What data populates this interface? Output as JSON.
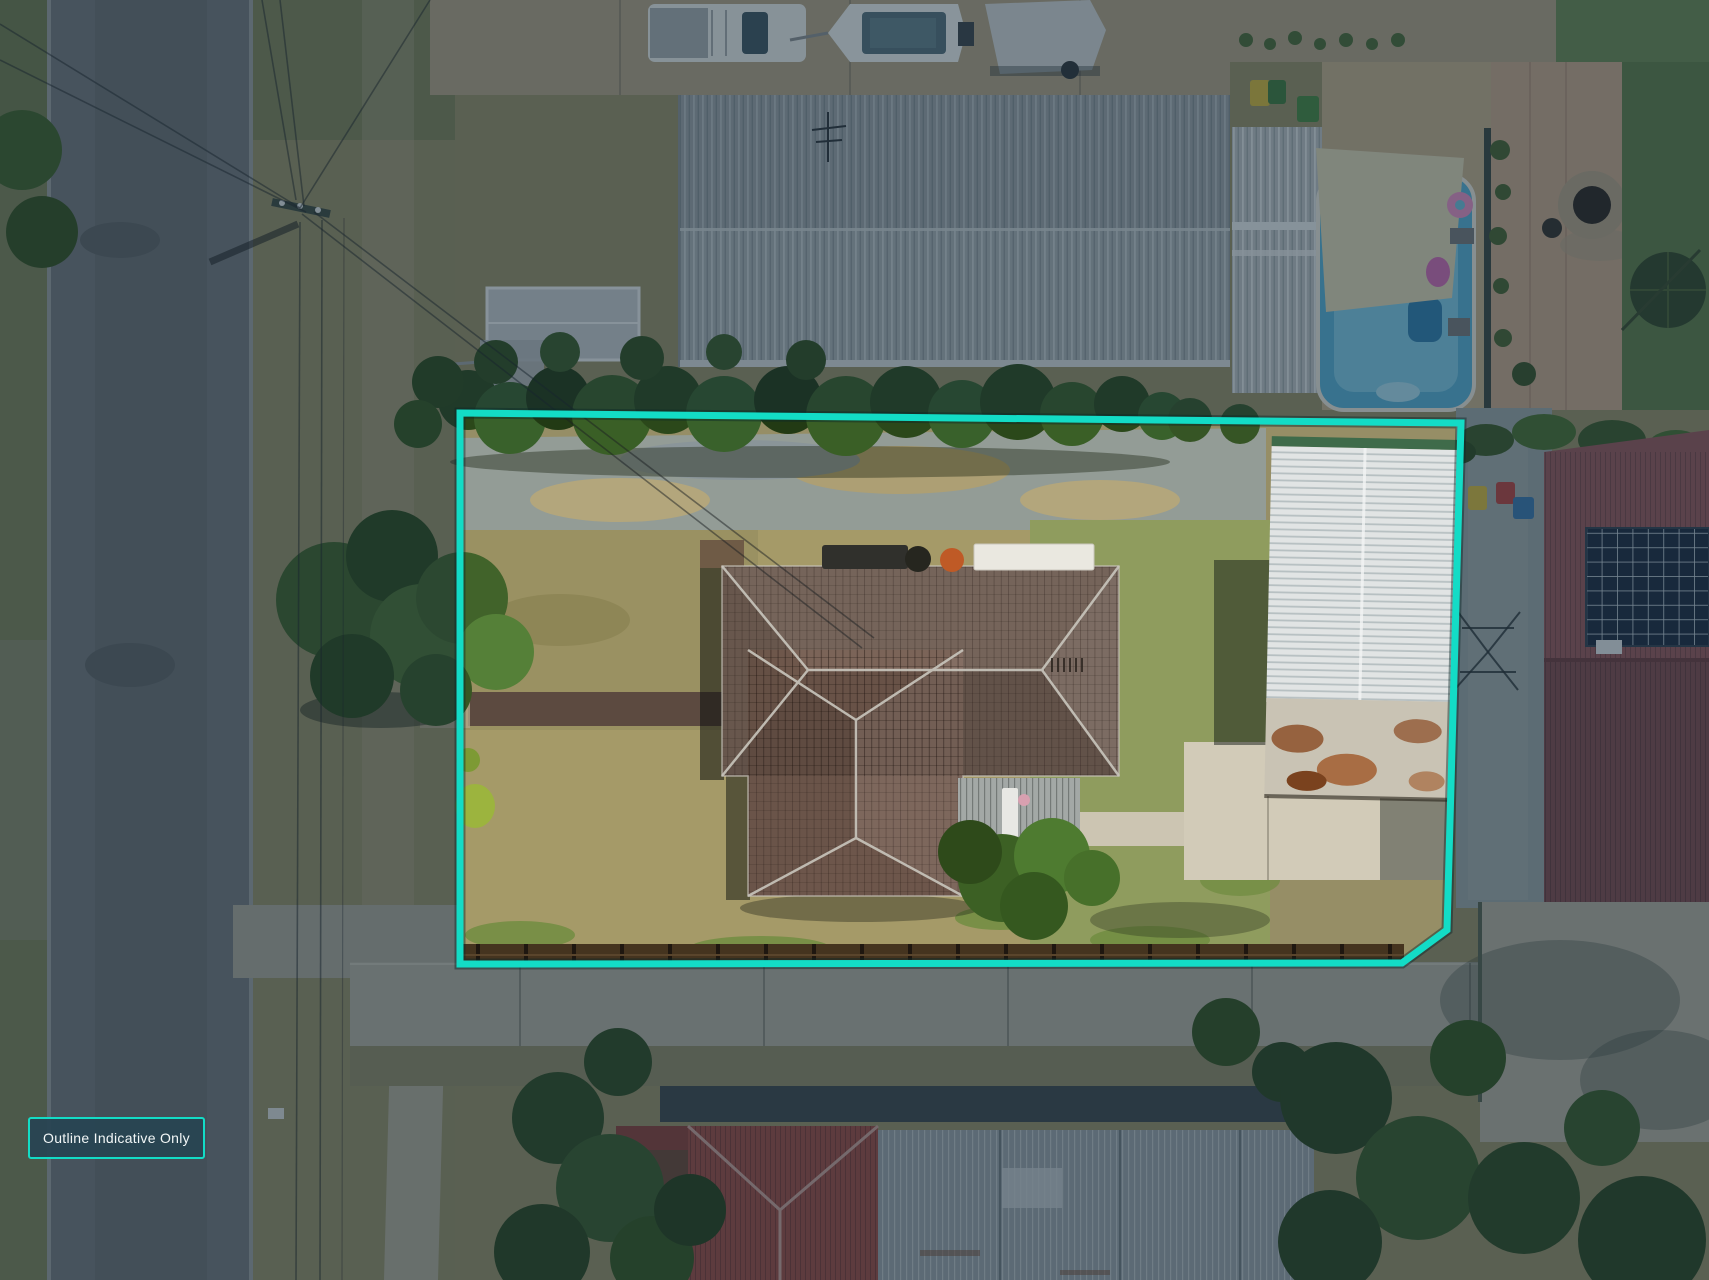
{
  "overlay": {
    "disclaimer_label": "Outline Indicative Only",
    "outline_color": "#13DCC6",
    "outline_points": "460,413 1461,423 1447,930 1402,963 460,964",
    "dim_color": "#13293a",
    "badge_background": "#2b4553",
    "badge_text_color": "#f2f7f7"
  }
}
